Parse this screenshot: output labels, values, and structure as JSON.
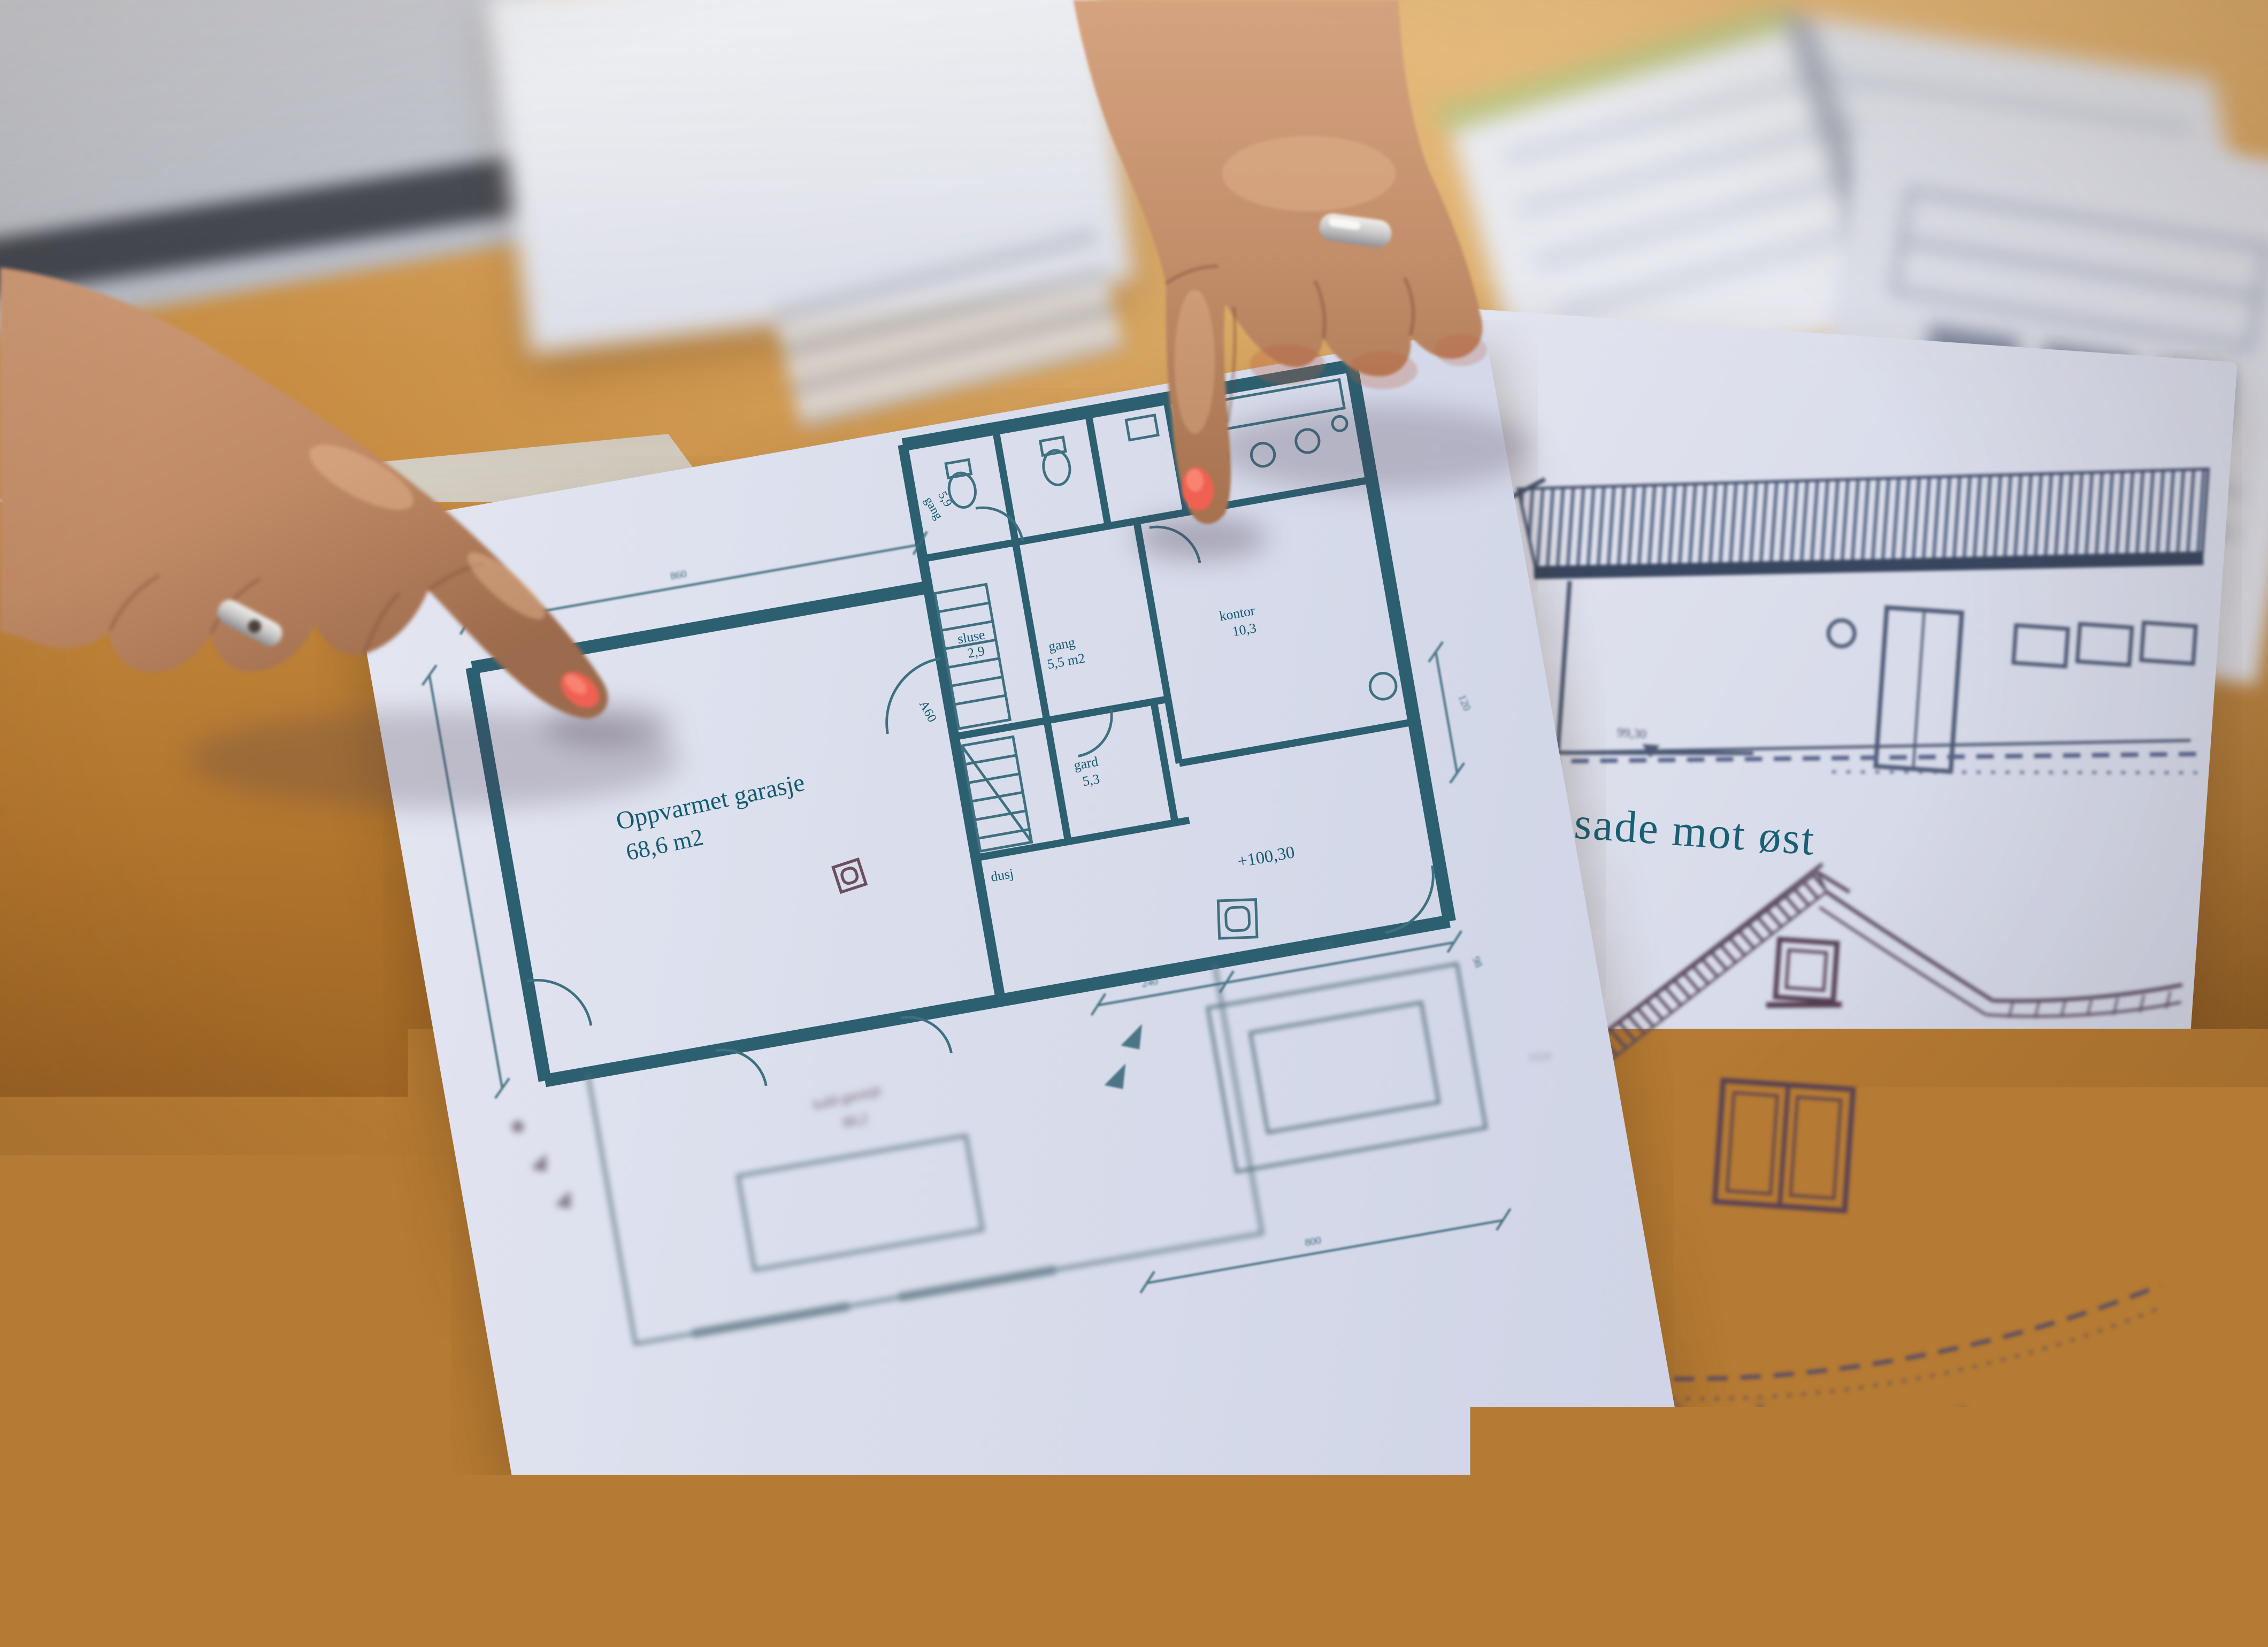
{
  "scene": {
    "description": "Two hands pointing at architectural drawings: a garage floor plan sheet and a facade sheet lying on a wooden table among blurred papers"
  },
  "floor_plan": {
    "heated_garage": {
      "label": "Oppvarmet garasje",
      "area": "68,6 m2"
    },
    "cold_garage": {
      "label": "kald garasje",
      "area": "80,2"
    },
    "sluse": {
      "label": "sluse",
      "area": "2,9"
    },
    "gard": {
      "label": "gard",
      "area": "5,3"
    },
    "dusj": {
      "label": "dusj"
    },
    "gang": {
      "label": "gang",
      "area": "5,5 m2"
    },
    "hall": {
      "label": "gang",
      "area": "5,9"
    },
    "kontor": {
      "label": "kontor",
      "area": "10,3"
    },
    "elevation_mark": "+100,30",
    "door_tag": "A60",
    "dims": {
      "top": "860",
      "a": "240",
      "b": "195",
      "c": "98",
      "d": "120",
      "e": "1020",
      "f": "800"
    }
  },
  "facades": {
    "east_label": "Fasade mot øst",
    "east_ground": "99,30",
    "north_label": "Fasade mot nord"
  },
  "site_plan": {
    "contour": "107"
  },
  "colors": {
    "plan_ink": "#2c5f70",
    "plan_text": "#145a70",
    "facade_east_ink": "#47597e",
    "facade_north_ink": "#5c4d63",
    "site_ink": "#6f5142",
    "table": "#c08033",
    "paper": "#d7dae8",
    "skin": "#c28f6d",
    "nail": "#ef6151",
    "ring": "#d7d5d2"
  }
}
